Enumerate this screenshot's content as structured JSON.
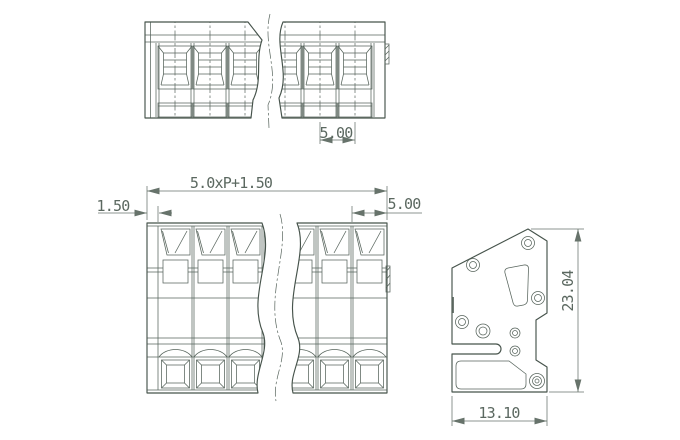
{
  "drawing": {
    "views": {
      "top": {
        "label": "top-view",
        "dimensions": {
          "pitch": "5.00"
        }
      },
      "front": {
        "label": "front-view",
        "dimensions": {
          "total_width": "5.0xP+1.50",
          "left_margin": "1.50",
          "pitch": "5.00"
        }
      },
      "side": {
        "label": "side-view",
        "dimensions": {
          "height": "23.04",
          "depth": "13.10"
        }
      }
    },
    "colors": {
      "line": "#46534b",
      "detail": "#57645c",
      "hidden": "#8b968f",
      "dim": "#67736b",
      "text": "#5b6860",
      "background": "#ffffff"
    }
  }
}
